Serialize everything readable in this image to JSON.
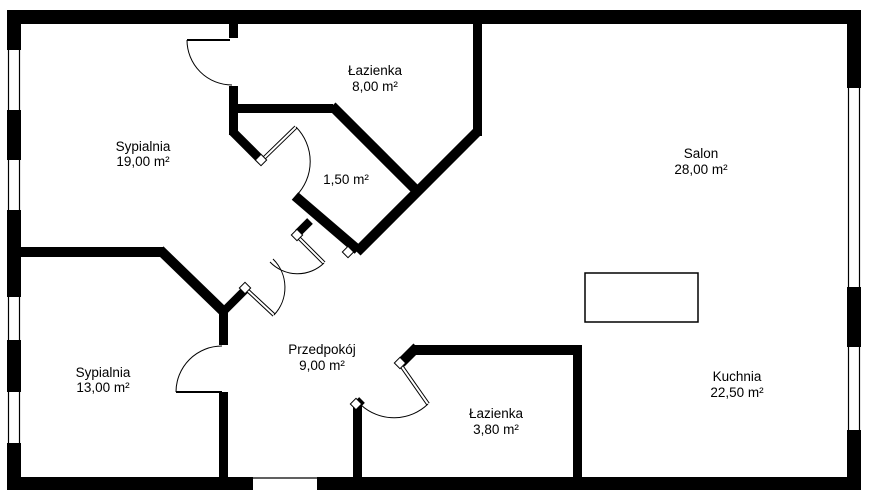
{
  "plan": {
    "type": "apartment-floor-plan",
    "language": "pl",
    "rooms": [
      {
        "id": "sypialnia-19",
        "name": "Sypialnia",
        "area": "19,00 m²"
      },
      {
        "id": "lazienka-8",
        "name": "Łazienka",
        "area": "8,00 m²"
      },
      {
        "id": "salon",
        "name": "Salon",
        "area": "28,00 m²"
      },
      {
        "id": "wc-1-50",
        "name": "",
        "area": "1,50 m²"
      },
      {
        "id": "sypialnia-13",
        "name": "Sypialnia",
        "area": "13,00 m²"
      },
      {
        "id": "przedpokoj",
        "name": "Przedpokój",
        "area": "9,00 m²"
      },
      {
        "id": "lazienka-3-80",
        "name": "Łazienka",
        "area": "3,80 m²"
      },
      {
        "id": "kuchnia",
        "name": "Kuchnia",
        "area": "22,50 m²"
      }
    ],
    "colors": {
      "wall": "#000000",
      "background": "#ffffff",
      "text": "#000000"
    }
  }
}
